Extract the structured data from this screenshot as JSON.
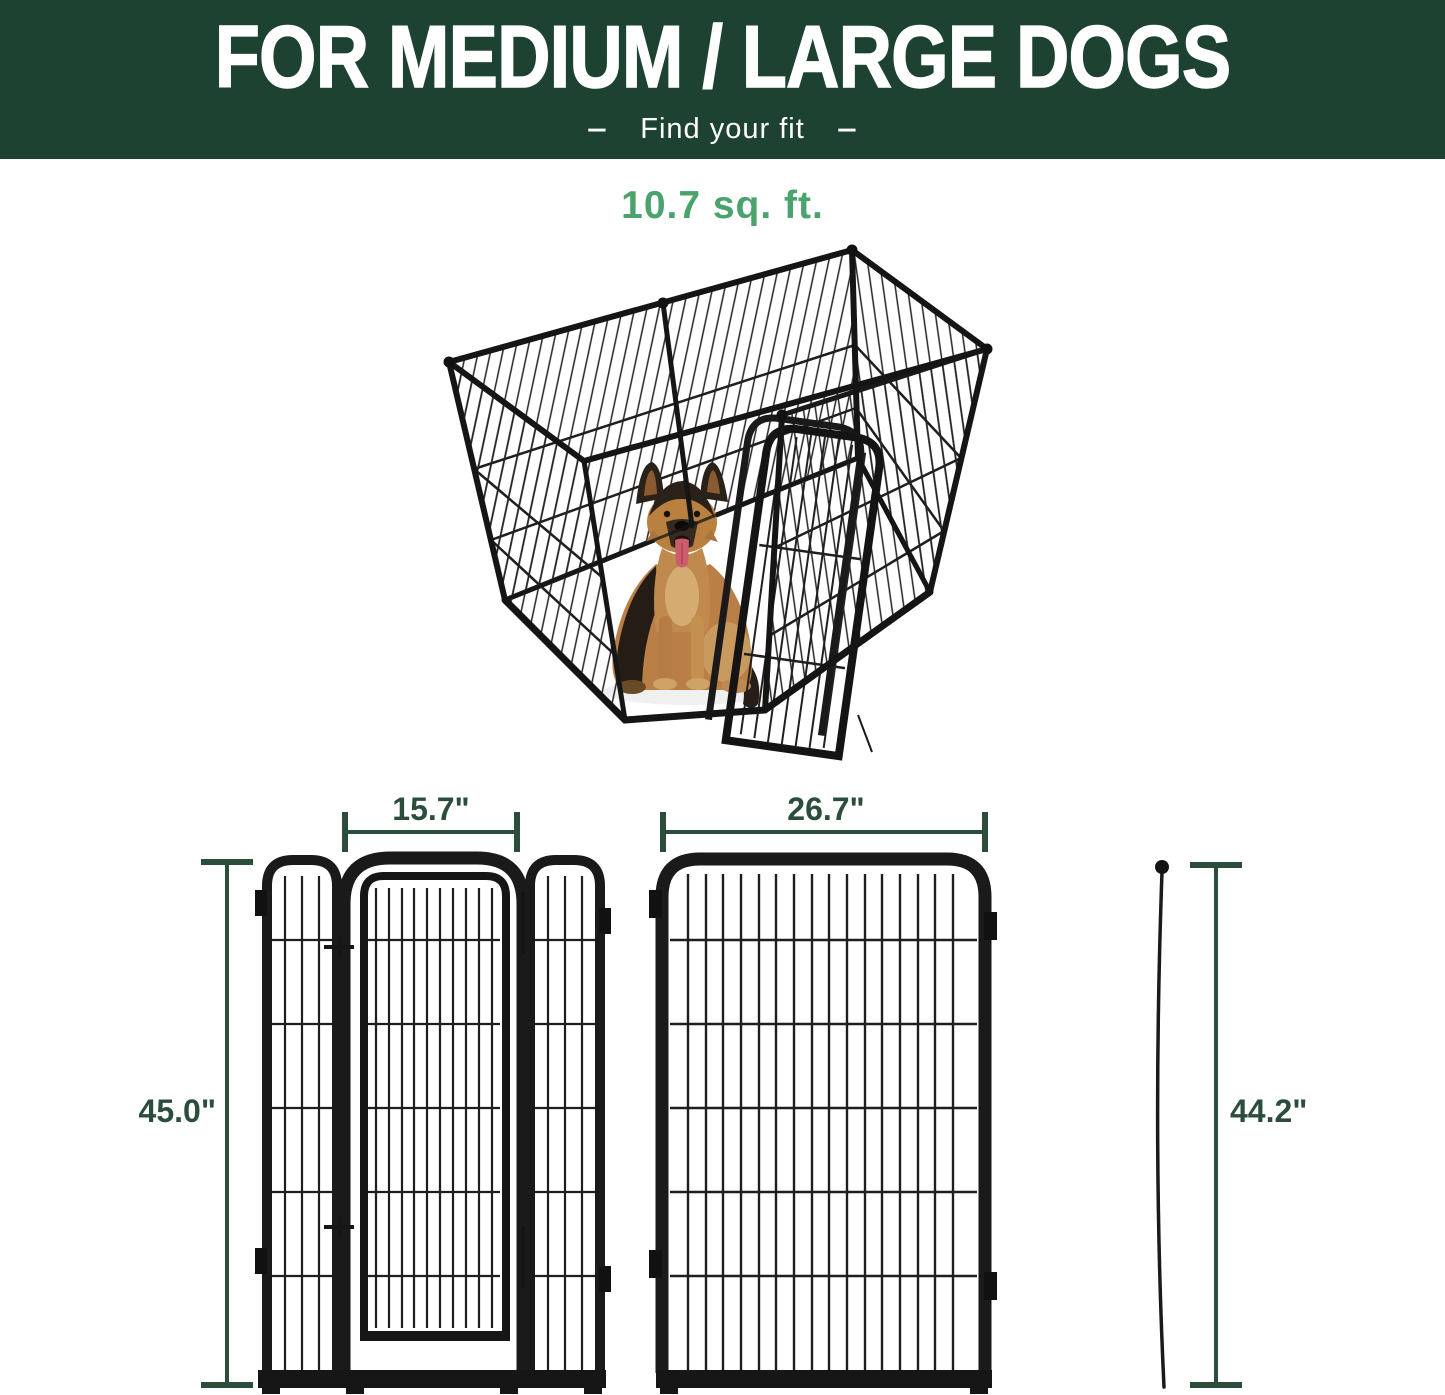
{
  "header": {
    "title": "FOR MEDIUM / LARGE DOGS",
    "dash_left": "–",
    "subtitle": "Find your fit",
    "dash_right": "–"
  },
  "hero": {
    "area_label": "10.7 sq. ft.",
    "description": "6-panel black metal dog playpen shown from above with a German Shepherd sitting inside and the gate door swung open"
  },
  "dimensions": {
    "gate_panel": {
      "width_label": "15.7\"",
      "height_label": "45.0\""
    },
    "large_panel": {
      "width_label": "26.7\"",
      "height_label": "44.2\""
    }
  },
  "colors": {
    "header_bg": "#1d4232",
    "header_text": "#ffffff",
    "area_label_green": "#4aa36c",
    "dimension_green": "#2b4e3c",
    "pen_metal_black": "#1a1a1a",
    "dog_tan": "#b97f46",
    "dog_dark": "#2a2119",
    "dog_tongue": "#cc5d6d"
  }
}
